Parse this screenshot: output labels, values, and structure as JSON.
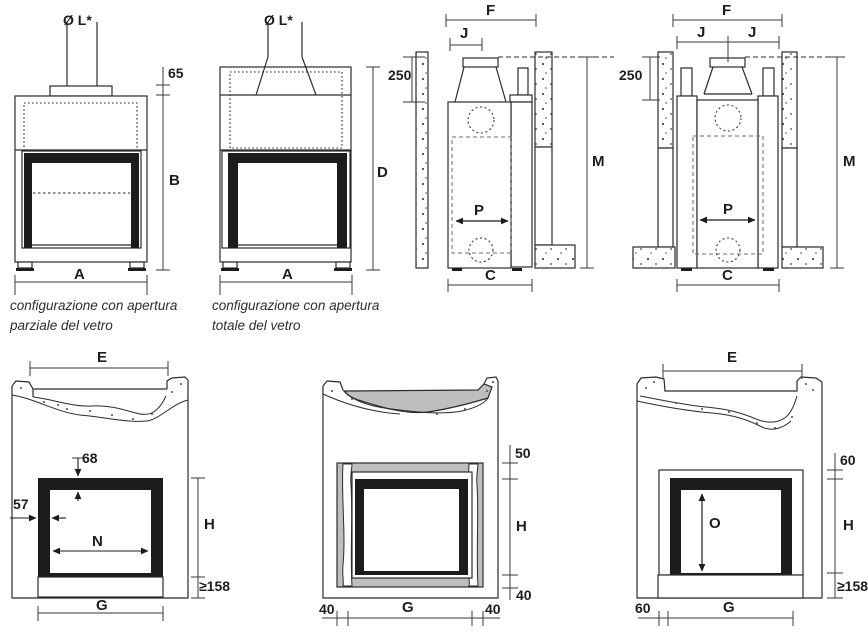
{
  "drawings": {
    "front_partial": {
      "flue": "Ø L*",
      "stub": "65",
      "height": "B",
      "width": "A",
      "caption1": "configurazione con apertura",
      "caption2": "parziale del vetro"
    },
    "front_total": {
      "flue": "Ø L*",
      "height": "D",
      "width": "A",
      "caption1": "configurazione con apertura",
      "caption2": "totale del vetro"
    },
    "side_single_flue": {
      "f": "F",
      "j": "J",
      "clearance": "250",
      "m": "M",
      "p": "P",
      "c": "C"
    },
    "side_double_flue": {
      "f": "F",
      "j_left": "J",
      "j_right": "J",
      "clearance": "250",
      "m": "M",
      "p": "P",
      "c": "C"
    },
    "rough_opening": {
      "e": "E",
      "top": "68",
      "side": "57",
      "n": "N",
      "h": "H",
      "base": "≥158",
      "g": "G"
    },
    "counterframe": {
      "top": "50",
      "h": "H",
      "bottom": "40",
      "left": "40",
      "g": "G",
      "right": "40"
    },
    "finished_opening": {
      "e": "E",
      "top": "60",
      "o": "O",
      "h": "H",
      "base": "≥158",
      "left": "60",
      "g": "G"
    }
  },
  "colors": {
    "line": "#2b2b2b",
    "black_fill": "#1c1c1c",
    "gray_fill": "#bdbfbf"
  }
}
